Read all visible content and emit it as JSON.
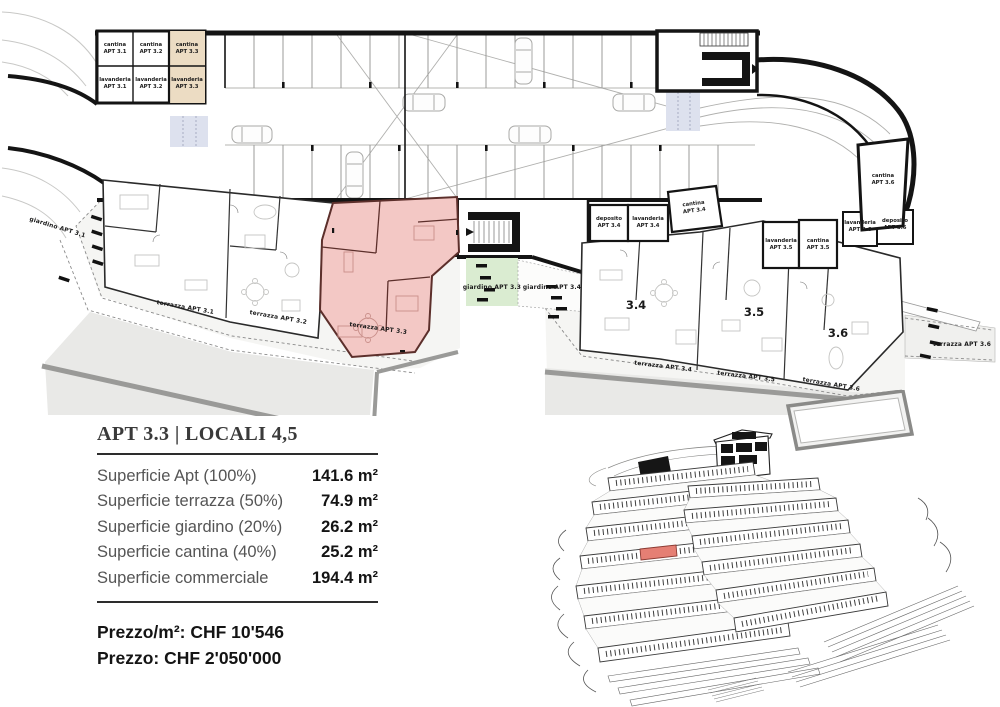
{
  "panel": {
    "title": "APT 3.3 | LOCALI 4,5",
    "rows": [
      {
        "label": "Superficie Apt (100%)",
        "value": "141.6 m²"
      },
      {
        "label": "Superficie terrazza (50%)",
        "value": "74.9 m²"
      },
      {
        "label": "Superficie giardino (20%)",
        "value": "26.2 m²"
      },
      {
        "label": "Superficie cantina (40%)",
        "value": "25.2 m²"
      },
      {
        "label": "Superficie commerciale",
        "value": "194.4 m²"
      }
    ],
    "price_per_m2_label": "Prezzo/m²: CHF 10'546",
    "price_total_label": "Prezzo: CHF 2'050'000"
  },
  "plan": {
    "highlighted_apartment": "3.3",
    "storage_grid": [
      {
        "room": "cantina",
        "apt": "APT 3.1"
      },
      {
        "room": "cantina",
        "apt": "APT 3.2"
      },
      {
        "room": "cantina",
        "apt": "APT 3.3"
      },
      {
        "room": "lavanderia",
        "apt": "APT 3.1"
      },
      {
        "room": "lavanderia",
        "apt": "APT 3.2"
      },
      {
        "room": "lavanderia",
        "apt": "APT 3.3"
      }
    ],
    "service_rooms": [
      {
        "room": "deposito",
        "apt": "APT 3.4"
      },
      {
        "room": "lavanderia",
        "apt": "APT 3.4"
      },
      {
        "room": "cantina",
        "apt": "APT 3.4"
      },
      {
        "room": "lavanderia",
        "apt": "APT 3.5"
      },
      {
        "room": "cantina",
        "apt": "APT 3.5"
      },
      {
        "room": "lavanderia",
        "apt": "APT 3.6"
      },
      {
        "room": "deposito",
        "apt": "APT 3.6"
      },
      {
        "room": "cantina",
        "apt": "APT 3.6"
      }
    ],
    "apartment_numbers": [
      "3.4",
      "3.5",
      "3.6"
    ],
    "terrace_labels": [
      "terrazza APT 3.1",
      "terrazza APT 3.2",
      "terrazza APT 3.3",
      "terrazza APT 3.4",
      "terrazza APT 3.5",
      "terrazza APT 3.6",
      "terrazza APT 3.6"
    ],
    "garden_labels": [
      "giardino APT 3.1",
      "giardino APT 3.3",
      "giardino APT 3.4"
    ]
  },
  "colors": {
    "apt_highlight": "#f3c8c5",
    "apt_highlight_wall": "#5c2f2b",
    "cantina_highlight": "#ecdcc3",
    "garden_green": "#daecd1",
    "ramp_blue": "#dde1ee",
    "terrace_gray": "#e9e9e7",
    "retaining_wall_gray": "#9a9a98",
    "wall_black": "#141414",
    "model_highlight": "#e57f74"
  }
}
